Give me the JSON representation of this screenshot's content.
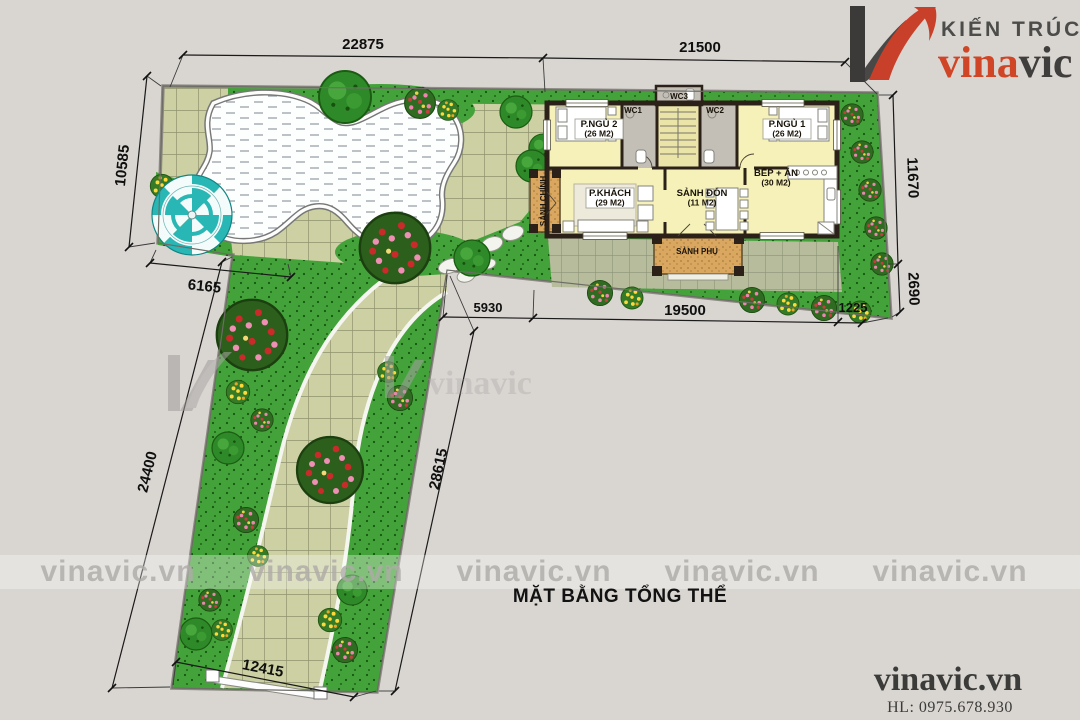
{
  "brand": {
    "tagline": "KIẾN TRÚC",
    "name_primary": "vina",
    "name_secondary": "vic",
    "color_primary": "#cf4526",
    "color_secondary": "#403e3c"
  },
  "title": "MẶT BẰNG TỔNG THỂ",
  "watermark": {
    "text": "vinavic.vn",
    "logo_text": "vinavic"
  },
  "footer": {
    "website": "vinavic.vn",
    "hotline": "HL: 0975.678.930"
  },
  "dimensions": {
    "top_width_left": "22875",
    "top_width_right": "21500",
    "left_height_upper": "10585",
    "left_offset": "6165",
    "strip_left_length": "24400",
    "strip_right_length": "28615",
    "bottom_width": "12415",
    "right_height_upper": "11670",
    "right_height_lower": "2690",
    "house_front_left": "5930",
    "house_front_mid": "19500",
    "house_front_right": "1225"
  },
  "rooms": {
    "bedroom2_name": "P.NGỦ 2",
    "bedroom2_area": "(26 M2)",
    "bedroom1_name": "P.NGỦ 1",
    "bedroom1_area": "(26 M2)",
    "living_name": "P.KHÁCH",
    "living_area": "(29 M2)",
    "hall_name": "SẢNH ĐÓN",
    "hall_area": "(11 M2)",
    "kitchen_name": "BẾP + ĂN",
    "kitchen_area": "(30 M2)",
    "wc1": "WC1",
    "wc2": "WC2",
    "wc3": "WC3",
    "main_porch": "SẢNH CHÍNH",
    "side_porch": "SẢNH PHỤ"
  },
  "colors": {
    "background": "#d9d6d2",
    "lawn": "#44a23a",
    "paving": "#ccd0a2",
    "house_floor": "#f6f1b8",
    "wall": "#2b2118",
    "porch": "#d9a75f",
    "umbrella": "#28b7b5"
  }
}
